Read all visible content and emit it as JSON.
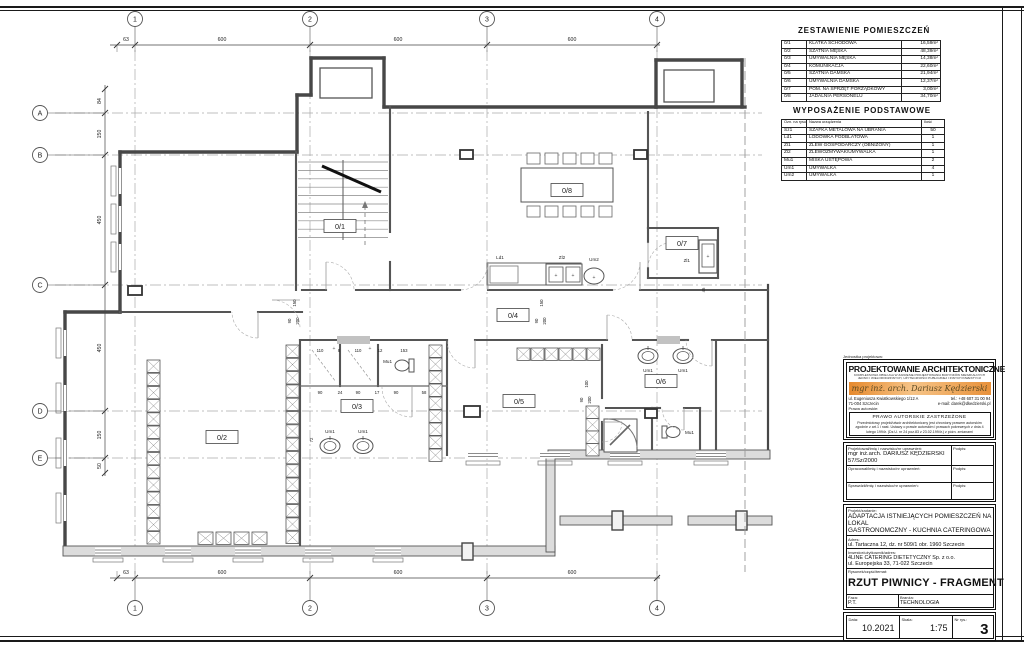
{
  "plan": {
    "grid_cols": [
      "1",
      "2",
      "3",
      "4"
    ],
    "grid_rows": [
      "A",
      "B",
      "C",
      "D",
      "E"
    ],
    "top_dims": [
      "63",
      "600",
      "600",
      "600"
    ],
    "bottom_dims": [
      "63",
      "600",
      "600",
      "600"
    ],
    "left_dims": [
      "84",
      "150",
      "450",
      "450",
      "150",
      "50"
    ],
    "rooms": [
      "0/1",
      "0/2",
      "0/3",
      "0/4",
      "0/5",
      "0/6",
      "0/7",
      "0/8"
    ],
    "fixtures": {
      "ld": "Ld1",
      "zl2": "Zl2",
      "um2": "Um2",
      "zl1": "Zl1",
      "mu": "Mu1",
      "um": "Um1"
    },
    "dims_wc_top": [
      "110",
      "8",
      "110",
      "12",
      "153"
    ],
    "dims_wc_bottom": [
      "90",
      "24",
      "90",
      "17",
      "90",
      "58"
    ],
    "rot_dims": [
      "150",
      "90",
      "200",
      "150",
      "90",
      "200",
      "100",
      "90",
      "200",
      "45",
      "72"
    ]
  },
  "rooms_table": {
    "title": "ZESTAWIENIE POMIESZCZEŃ",
    "rows": [
      [
        "0/1",
        "KLATKA SCHODOWA",
        "16,59m²"
      ],
      [
        "0/2",
        "SZATNIA MĘSKA",
        "48,39m²"
      ],
      [
        "0/3",
        "UMYWALNIA MĘSKA",
        "14,38m²"
      ],
      [
        "0/4",
        "KOMUNIKACJA",
        "22,60m²"
      ],
      [
        "0/5",
        "SZATNIA DAMSKA",
        "21,94m²"
      ],
      [
        "0/6",
        "UMYWALNIA DAMSKA",
        "12,37m²"
      ],
      [
        "0/7",
        "POM. NA SPRZĘT PORZĄDKOWY",
        "3,00m²"
      ],
      [
        "0/8",
        "JADALNIA PERSONELU",
        "34,70m²"
      ]
    ]
  },
  "equipment_table": {
    "title": "WYPOSAŻENIE PODSTAWOWE",
    "headers": [
      "Ozn. na rysunku",
      "Nazwa urządzenia",
      "Ilość"
    ],
    "rows": [
      [
        "Sz1",
        "SZAFKA METALOWA NA UBRANIA",
        "50"
      ],
      [
        "Ld1",
        "LODÓWKA PODBLATOWA",
        "1"
      ],
      [
        "Zl1",
        "ZLEW GOSPODARCZY (OBNIŻONY)",
        "1"
      ],
      [
        "Zl2",
        "ZLEWOZMYWAK/UMYWALKA",
        "1"
      ],
      [
        "Mu1",
        "MISKA USTĘPOWA",
        "2"
      ],
      [
        "Um1",
        "UMYWALKA",
        "4"
      ],
      [
        "Um2",
        "UMYWALKA",
        "1"
      ]
    ]
  },
  "designer": {
    "unit_label": "Jednostka projektowa:",
    "name": "PROJEKTOWANIE ARCHITEKTONICZNE",
    "subtitle1": "KOMPLEKSOWA OBSŁUGA W ZAKRESIE PROJEKTOWANIA BUDYNKÓW MIESZKALNYCH",
    "subtitle2": "JEDNO I WIELORODZINNYCH, UŻYTECZNOŚCI PUBLICZNEJ I INNYCH INWESTYCJI",
    "stamp": "mgr inż. arch. Dariusz Kędzierski",
    "address1": "ul. Eugeniusza Kwiatkowskiego 1/12 A",
    "address2": "71-004 Szczecin",
    "tel": "tel.: +48 607 31 00 94",
    "email": "e-mail: darek@dkedzierski.pl"
  },
  "copyright": {
    "label": "Prawa autorskie:",
    "title": "PRAWO AUTORSKIE ZASTRZEŻONE",
    "text": "Przedmiotowy projekt/utwór architektoniczny jest chroniony prawem autorskim zgodnie z art.1 i nast. Ustawy o prawie autorskim i prawach pokrewnych z dnia 4 lutego 1994r. (Dz.U. nr 24 poz.83 z 23.02.1994r.) z późn. zmianami"
  },
  "signatures": {
    "rows": [
      {
        "label": "Projektował/imię i nazwisko/nr uprawnień:",
        "value1": "mgr inż.arch. DARIUSZ KĘDZIERSKI",
        "value2": "57/Sz/2000",
        "sign_label": "Podpis:"
      },
      {
        "label": "Opracował/imię i nazwisko/nr uprawnień:",
        "value1": "",
        "value2": "",
        "sign_label": "Podpis:"
      },
      {
        "label": "Sprawdził/imię i nazwisko/nr uprawnień:",
        "value1": "",
        "value2": "",
        "sign_label": "Podpis:"
      }
    ]
  },
  "project": {
    "project_label": "Projekt/zadanie:",
    "project_line1": "ADAPTACJA ISTNIEJĄCYCH POMIESZCZEŃ NA LOKAL",
    "project_line2": "GASTRONOMCZNY - KUCHNIA CATERINGOWA",
    "address_label": "Adres:",
    "address": "ul. Tartaczna 12, dz. nr 509/1 obr. 1960 Szczecin",
    "investor_label": "Inwestor/użytkownik/adres:",
    "investor1": "4LINE CATERING DIETETYCZNY Sp. z o.o.",
    "investor2": "ul. Europejska 33, 71-022 Szczecin",
    "drawing_label": "Rysunek/część/temat:",
    "drawing": "RZUT PIWNICY - FRAGMENT",
    "phase_label": "Faza:",
    "phase": "P.T.",
    "branch_label": "Branża:",
    "branch": "TECHNOLOGIA"
  },
  "footer": {
    "date_label": "Data:",
    "date": "10.2021",
    "scale_label": "Skala:",
    "scale": "1:75",
    "number_label": "Nr rys.:",
    "number": "3"
  }
}
